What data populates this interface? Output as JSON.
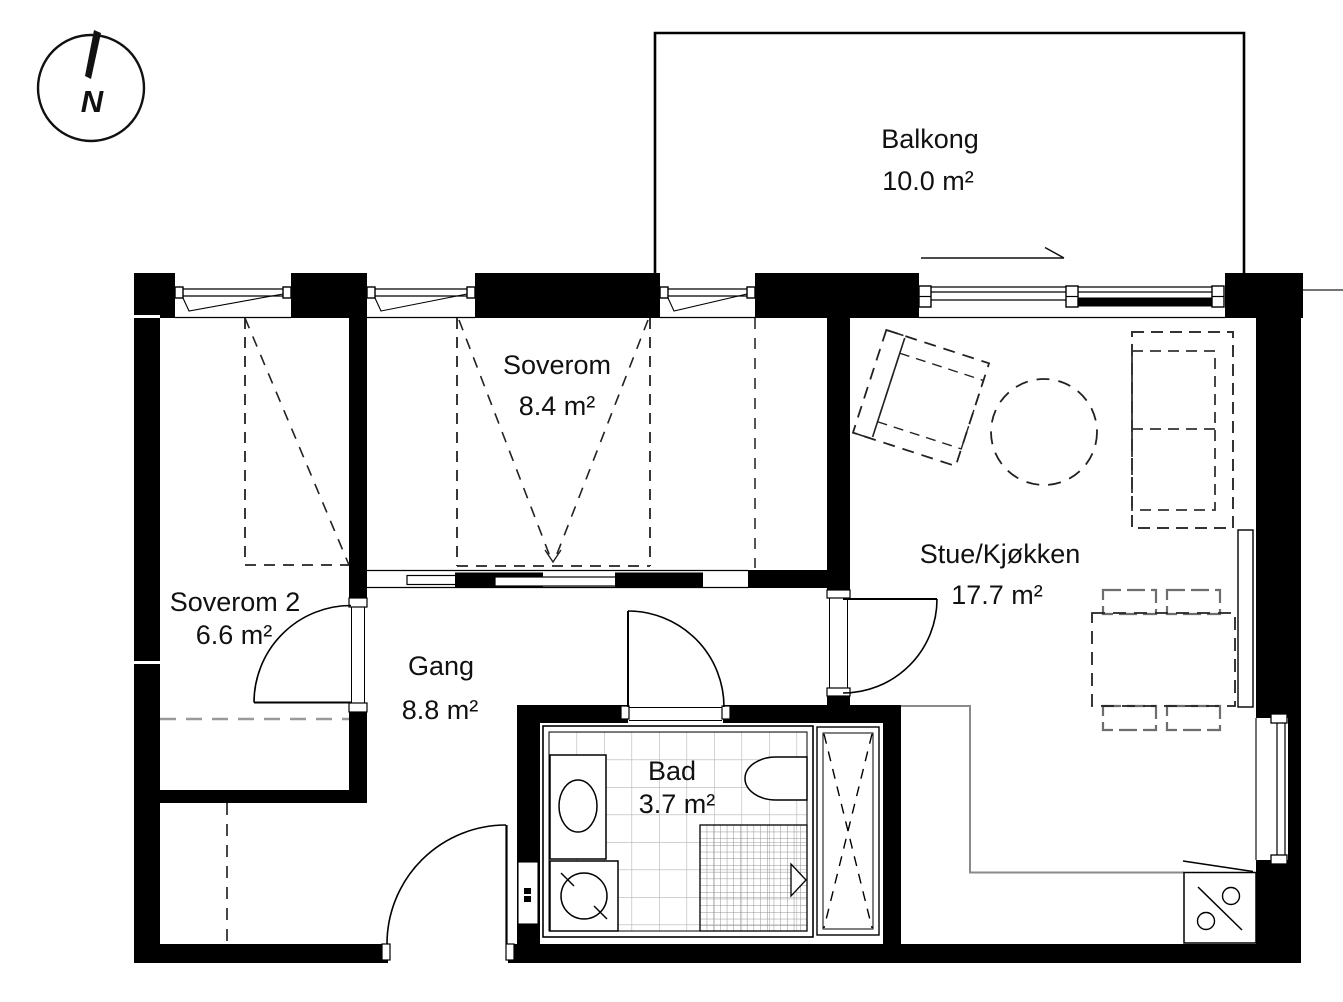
{
  "title": "Apartment floor plan",
  "compass": {
    "north_label": "N"
  },
  "rooms": {
    "balkong": {
      "name": "Balkong",
      "area": "10.0 m²"
    },
    "soverom": {
      "name": "Soverom",
      "area": "8.4 m²"
    },
    "soverom2": {
      "name": "Soverom 2",
      "area": "6.6 m²"
    },
    "stue": {
      "name": "Stue/Kjøkken",
      "area": "17.7 m²"
    },
    "gang": {
      "name": "Gang",
      "area": "8.8 m²"
    },
    "bad": {
      "name": "Bad",
      "area": "3.7 m²"
    }
  },
  "colors": {
    "wall": "#000000",
    "text": "#111111",
    "tile_grid": "#b5b5b5",
    "shower_grid": "#909090",
    "counter_line": "#8a8a8a",
    "furniture_dash": "#222222",
    "hint_dash": "#999999"
  }
}
